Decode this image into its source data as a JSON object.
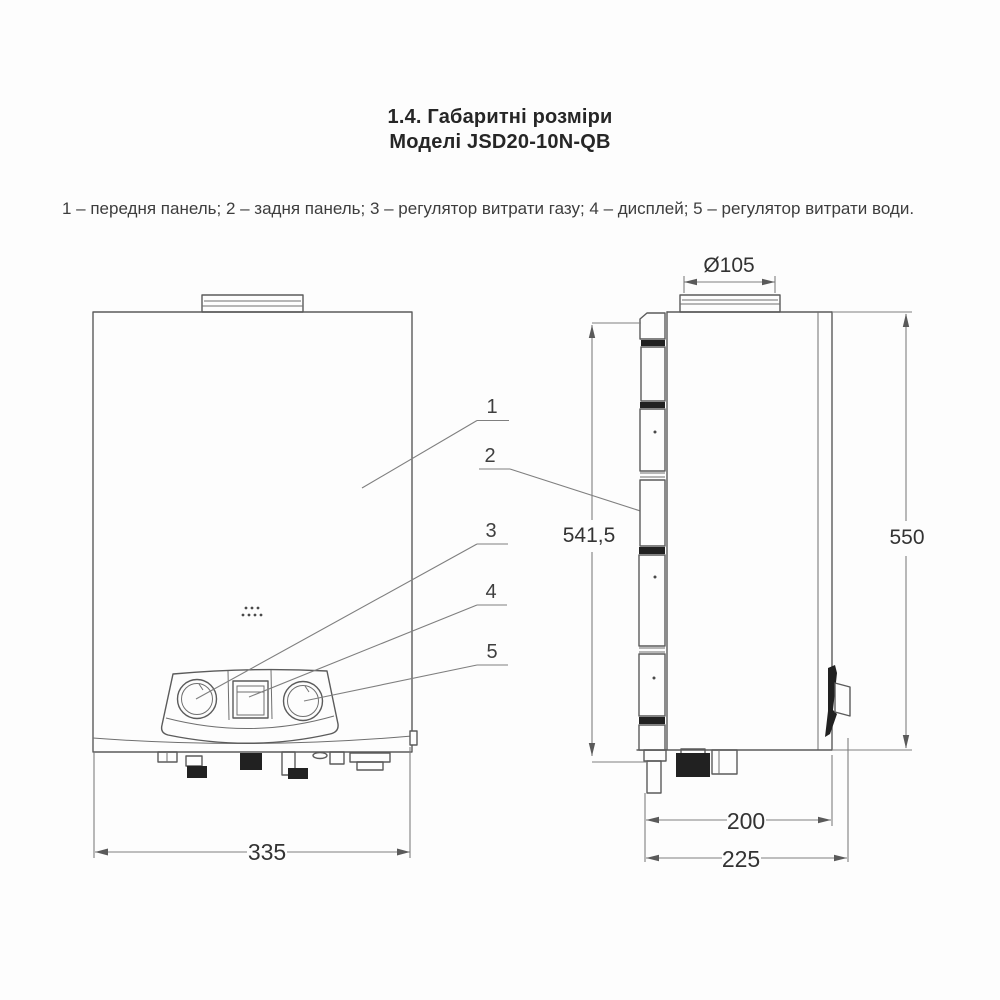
{
  "page": {
    "title_line1": "1.4. Габаритні розміри",
    "title_line2": "Моделі JSD20-10N-QB",
    "legend": "1 – передня панель; 2 – задня панель; 3 – регулятор витрати газу; 4 – дисплей; 5 – регулятор витрати води."
  },
  "callouts": [
    {
      "num": "1",
      "label": "передня панель"
    },
    {
      "num": "2",
      "label": "задня панель"
    },
    {
      "num": "3",
      "label": "регулятор витрати газу"
    },
    {
      "num": "4",
      "label": "дисплей"
    },
    {
      "num": "5",
      "label": "регулятор витрати води"
    }
  ],
  "dimensions": {
    "flue_diameter": "Ø105",
    "back_panel_height": "541,5",
    "overall_height": "550",
    "front_width": "335",
    "body_depth": "200",
    "overall_depth": "225"
  }
}
